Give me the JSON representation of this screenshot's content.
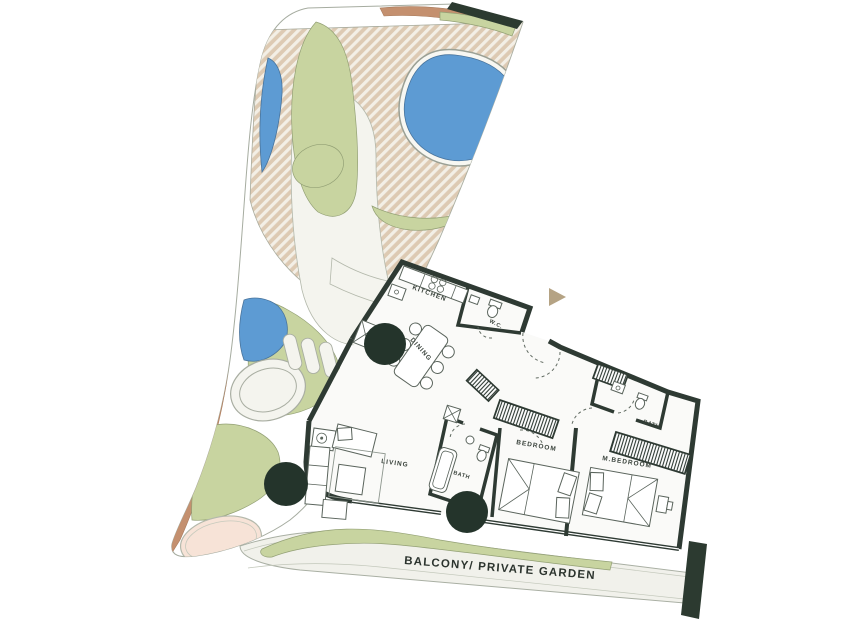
{
  "colors": {
    "wall": "#2e3a33",
    "tree": "#24342b",
    "garden_green": "#c8d4a0",
    "water_blue": "#5d9bd3",
    "sand_hatch": "#ddcab3",
    "terracotta": "#c4906f",
    "peach": "#f7e3d7",
    "dark_bar": "#2c3a30",
    "arrow": "#b5a384",
    "floor": "#fafaf8",
    "garden_base": "#f4f4ee",
    "outline": "#a6aca0",
    "label_text": "#39423b"
  },
  "rooms": {
    "kitchen": "KITCHEN",
    "wc": "W.C.",
    "dining": "DINING",
    "living": "LIVING",
    "bath": "BATH",
    "bedroom": "BEDROOM",
    "master_bedroom": "M.BEDROOM",
    "master_bath": "BATH",
    "balcony": "BALCONY/ PRIVATE GARDEN"
  }
}
